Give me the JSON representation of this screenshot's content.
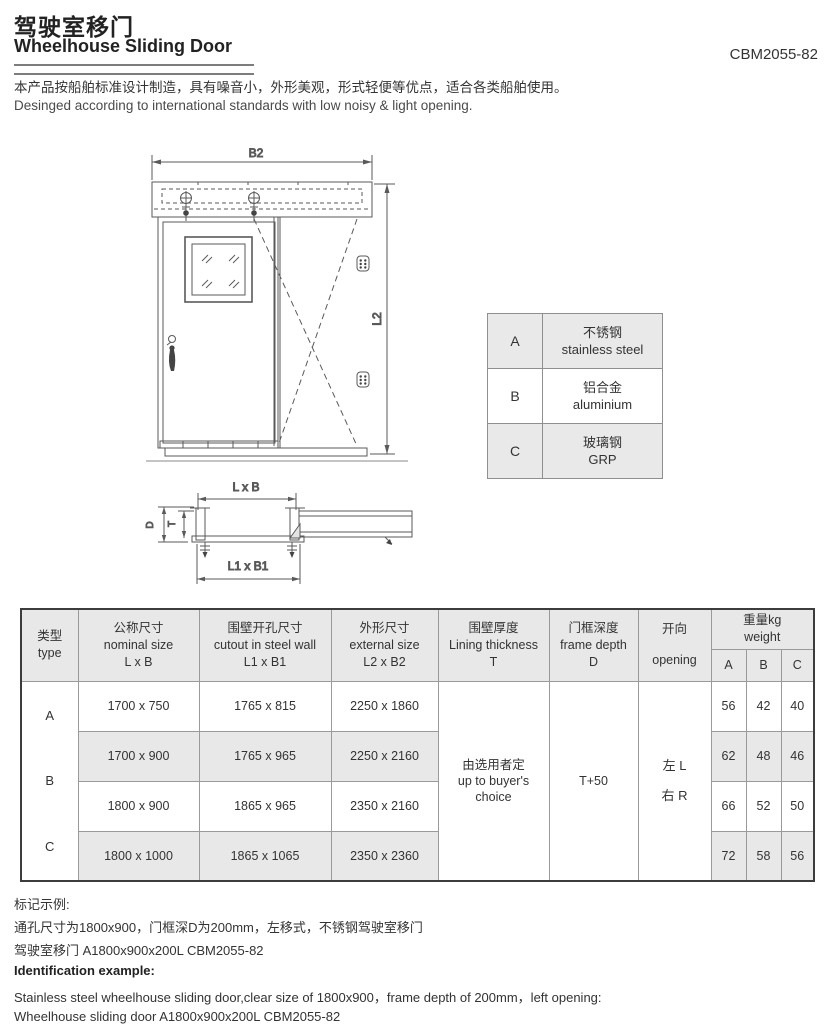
{
  "header": {
    "title_zh": "驾驶室移门",
    "title_en": "Wheelhouse Sliding Door",
    "product_code": "CBM2055-82",
    "desc_zh": "本产品按船舶标准设计制造，具有噪音小，外形美观，形式轻便等优点，适合各类船舶使用。",
    "desc_en": "Desinged according to international standards with low noisy & light opening."
  },
  "drawing": {
    "b2": "B2",
    "l2": "L2",
    "lxb": "L x B",
    "l1xb1": "L1 x B1",
    "d": "D",
    "t": "T"
  },
  "material_table": {
    "rows": [
      {
        "code": "A",
        "name_zh": "不锈钢",
        "name_en": "stainless steel"
      },
      {
        "code": "B",
        "name_zh": "铝合金",
        "name_en": "aluminium"
      },
      {
        "code": "C",
        "name_zh": "玻璃钢",
        "name_en": "GRP"
      }
    ]
  },
  "spec_table": {
    "headers": {
      "type_zh": "类型",
      "type_en": "type",
      "nominal_zh": "公称尺寸",
      "nominal_en": "nominal size",
      "nominal_sym": "L x B",
      "cutout_zh": "围壁开孔尺寸",
      "cutout_en": "cutout in steel wall",
      "cutout_sym": "L1 x B1",
      "external_zh": "外形尺寸",
      "external_en": "external size",
      "external_sym": "L2 x B2",
      "lining_zh": "围壁厚度",
      "lining_en": "Lining thickness",
      "lining_sym": "T",
      "frame_zh": "门框深度",
      "frame_en": "frame depth",
      "frame_sym": "D",
      "opening_zh": "开向",
      "opening_en": "opening",
      "weight_zh": "重量kg",
      "weight_en": "weight",
      "wa": "A",
      "wb": "B",
      "wc": "C"
    },
    "type_a": "A",
    "type_b": "B",
    "type_c": "C",
    "lining_zh": "由选用者定",
    "lining_en1": "up to buyer's",
    "lining_en2": "choice",
    "frame_depth": "T+50",
    "opening_left": "左 L",
    "opening_right": "右 R",
    "rows": [
      {
        "nominal": "1700 x 750",
        "cutout": "1765 x 815",
        "external": "2250 x 1860",
        "wa": "56",
        "wb": "42",
        "wc": "40"
      },
      {
        "nominal": "1700 x 900",
        "cutout": "1765 x 965",
        "external": "2250 x 2160",
        "wa": "62",
        "wb": "48",
        "wc": "46"
      },
      {
        "nominal": "1800 x 900",
        "cutout": "1865 x 965",
        "external": "2350 x 2160",
        "wa": "66",
        "wb": "52",
        "wc": "50"
      },
      {
        "nominal": "1800 x 1000",
        "cutout": "1865 x 1065",
        "external": "2350 x 2360",
        "wa": "72",
        "wb": "58",
        "wc": "56"
      }
    ]
  },
  "footer": {
    "zh_title": "标记示例:",
    "zh_line1": "通孔尺寸为1800x900，门框深D为200mm，左移式，不锈钢驾驶室移门",
    "zh_line2": "驾驶室移门 A1800x900x200L CBM2055-82",
    "en_title": "Identification example:",
    "en_line1": "Stainless steel wheelhouse sliding door,clear size of 1800x900，frame depth of 200mm，left opening:",
    "en_line2": "Wheelhouse sliding door A1800x900x200L CBM2055-82"
  }
}
